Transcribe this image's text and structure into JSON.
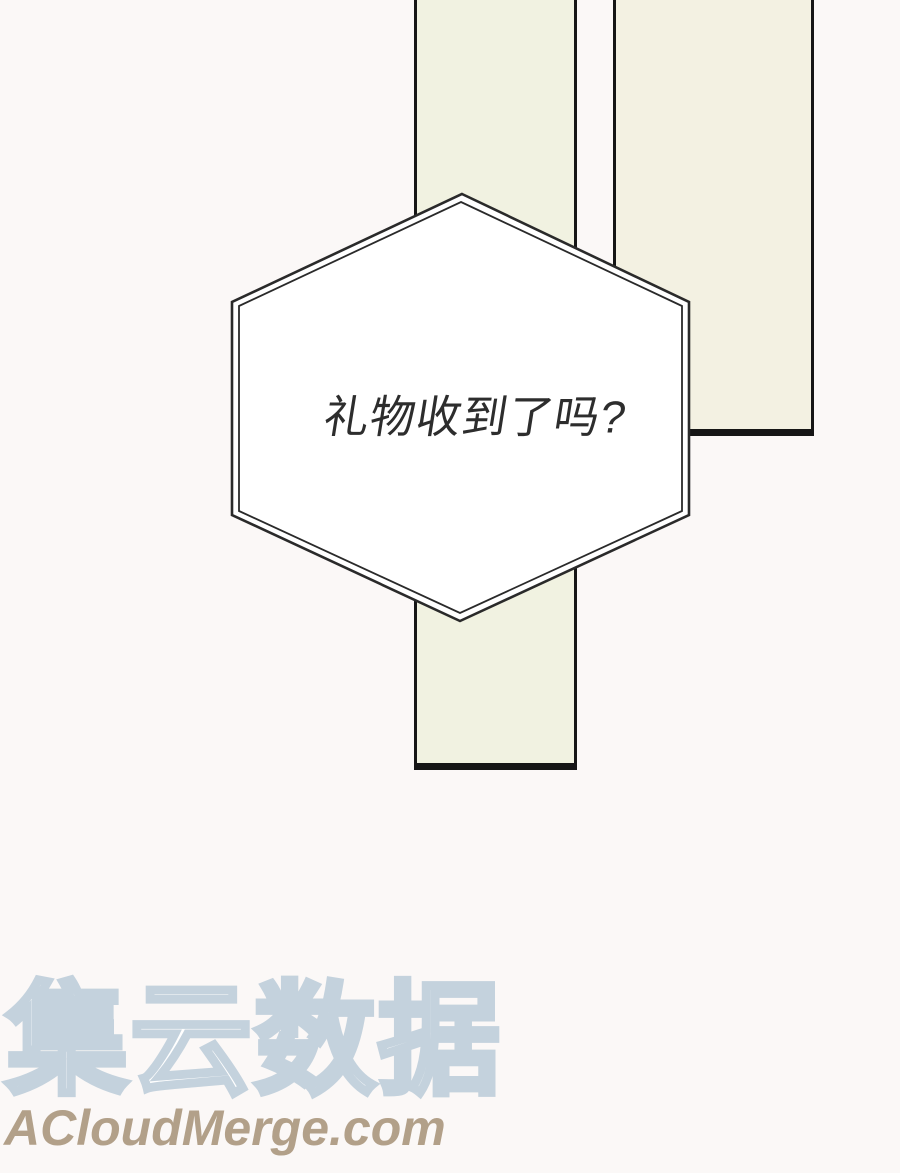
{
  "colors": {
    "background": "#fbf8f7",
    "panel_fill": "#f1f2e1",
    "panel_fill_2": "#f3f1e2",
    "panel_border": "#161616",
    "bubble_fill": "#ffffff",
    "bubble_outline": "#2a2a2a",
    "bubble_text": "#2d2d2d",
    "watermark_outline": "#c4d2dd",
    "watermark_url": "#b2a089"
  },
  "speech_bubble": {
    "shape": "hexagon",
    "text": "礼物收到了吗?"
  },
  "watermark": {
    "brand": "集云数据",
    "url": "ACloudMerge.com"
  }
}
